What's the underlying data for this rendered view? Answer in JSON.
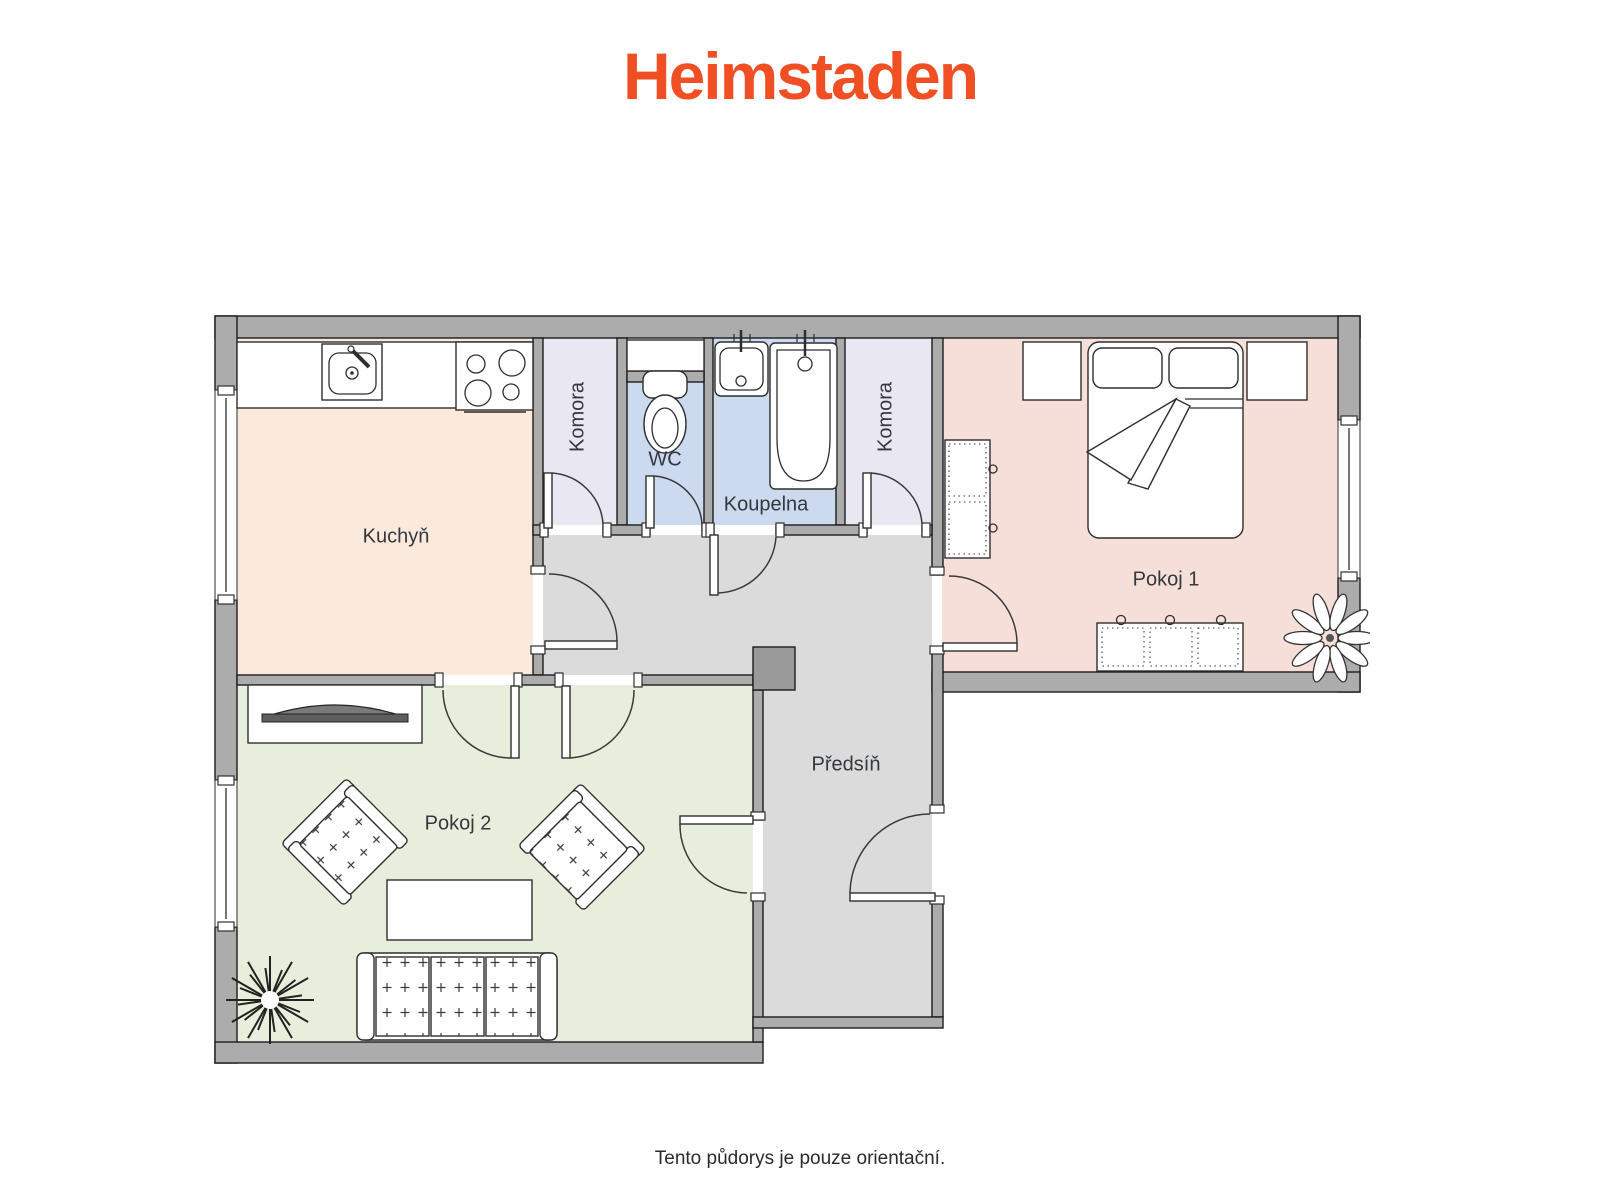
{
  "brand": {
    "logo_text": "Heimstaden",
    "color": "#F04E23"
  },
  "caption": {
    "text": "Tento půdorys je pouze orientační."
  },
  "rooms": {
    "kuchyn": {
      "label": "Kuchyň",
      "floor_color": "#FBE9DB",
      "fixtures": [
        "kitchen-counter",
        "kitchen-sink",
        "stove"
      ]
    },
    "komora1": {
      "label": "Komora",
      "floor_color": "#E9E7F1",
      "fixtures": []
    },
    "wc": {
      "label": "WC",
      "floor_color": "#CBDAEE",
      "fixtures": [
        "toilet"
      ]
    },
    "koupelna": {
      "label": "Koupelna",
      "floor_color": "#CBDAEE",
      "fixtures": [
        "washbasin",
        "bathtub"
      ]
    },
    "komora2": {
      "label": "Komora",
      "floor_color": "#E9E7F1",
      "fixtures": []
    },
    "pokoj1": {
      "label": "Pokoj 1",
      "floor_color": "#F7DFD9",
      "fixtures": [
        "double-bed",
        "nightstand",
        "nightstand",
        "wardrobe",
        "dresser",
        "plant"
      ]
    },
    "pokoj2": {
      "label": "Pokoj 2",
      "floor_color": "#E7EEDB",
      "fixtures": [
        "tv-cabinet",
        "armchair",
        "armchair",
        "coffee-table",
        "sofa",
        "plant"
      ]
    },
    "predsin": {
      "label": "Předsíň",
      "floor_color": "#DBDBDB",
      "fixtures": [
        "shaft"
      ]
    }
  },
  "colors": {
    "wall": "#ACACAC",
    "shaft": "#9A9A9A",
    "outline": "#1C1C1C"
  }
}
